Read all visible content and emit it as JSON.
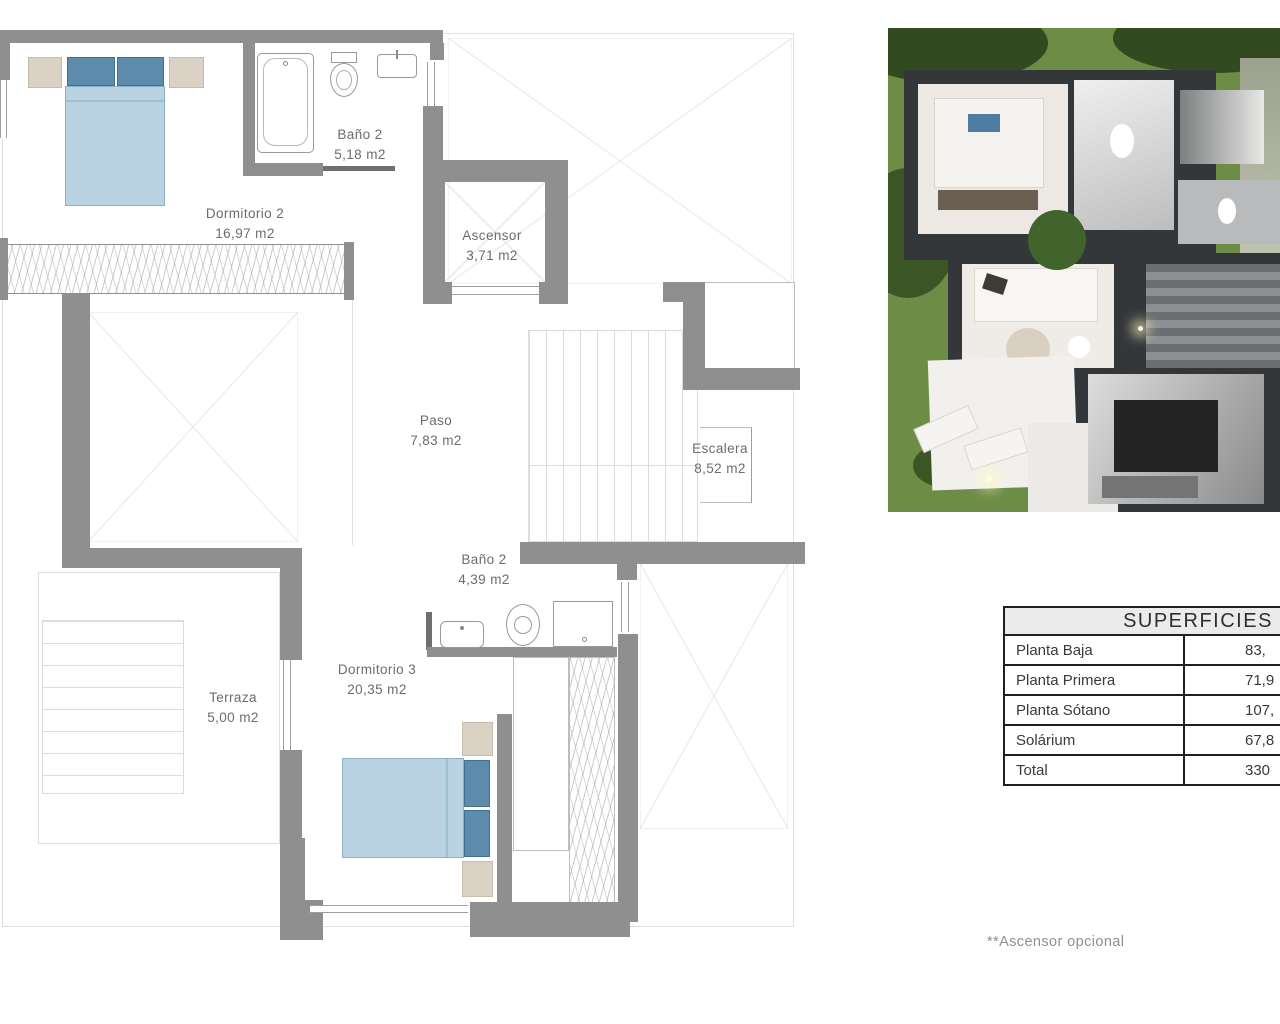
{
  "floor_plan": {
    "rooms": [
      {
        "name": "Dormitorio 2",
        "area": "16,97 m2"
      },
      {
        "name": "Baño 2",
        "area": "5,18 m2"
      },
      {
        "name": "Ascensor",
        "area": "3,71 m2"
      },
      {
        "name": "Paso",
        "area": "7,83 m2"
      },
      {
        "name": "Escalera",
        "area": "8,52 m2"
      },
      {
        "name": "Baño 2",
        "area": "4,39 m2"
      },
      {
        "name": "Dormitorio 3",
        "area": "20,35 m2"
      },
      {
        "name": "Terraza",
        "area": "5,00 m2"
      }
    ]
  },
  "surfaces_table": {
    "title": "SUPERFICIES",
    "rows": [
      {
        "label": "Planta Baja",
        "value": "83,"
      },
      {
        "label": "Planta Primera",
        "value": "71,9"
      },
      {
        "label": "Planta Sótano",
        "value": "107,"
      },
      {
        "label": "Solárium",
        "value": "67,8"
      },
      {
        "label": "Total",
        "value": "330"
      }
    ]
  },
  "footnote": "**Ascensor opcional",
  "colors": {
    "wall_gray": "#8f8f8f",
    "bed_blue": "#b9d3e3",
    "pillow_blue": "#5d8bac",
    "nightstand_beige": "#dbd1c4",
    "table_border": "#1f1f1f",
    "header_bg": "#ebebeb",
    "grass_green": "#6d8c45"
  }
}
